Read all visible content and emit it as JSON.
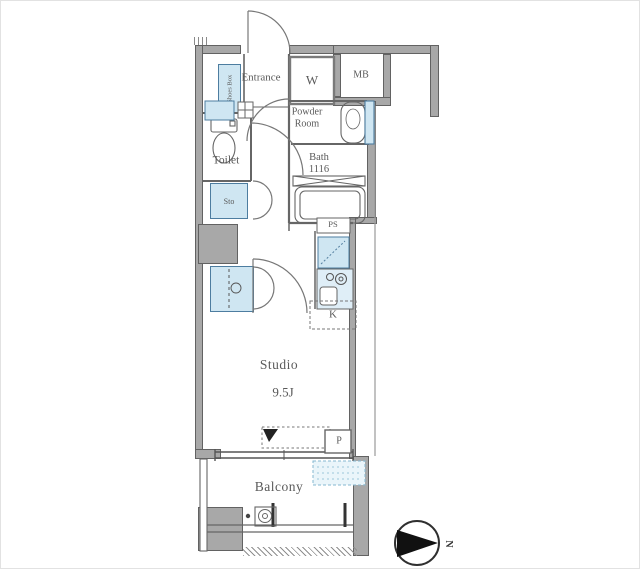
{
  "floorplan": {
    "labels": {
      "entrance": "Entrance",
      "closet": "W",
      "meter_box": "MB",
      "powder_room": "Powder\nRoom",
      "bath": "Bath\n1116",
      "toilet": "Toilet",
      "storage": "Sto",
      "shoes_box": "Shoes Box",
      "pipe_shaft": "PS",
      "kitchen": "K",
      "studio": "Studio",
      "studio_size": "9.5J",
      "pipe": "P",
      "balcony": "Balcony",
      "north": "N"
    },
    "colors": {
      "wall_gray": "#a8a8a8",
      "fixture_blue": "#cfe6f2",
      "line": "#666666",
      "text": "#5a5a5a"
    }
  }
}
